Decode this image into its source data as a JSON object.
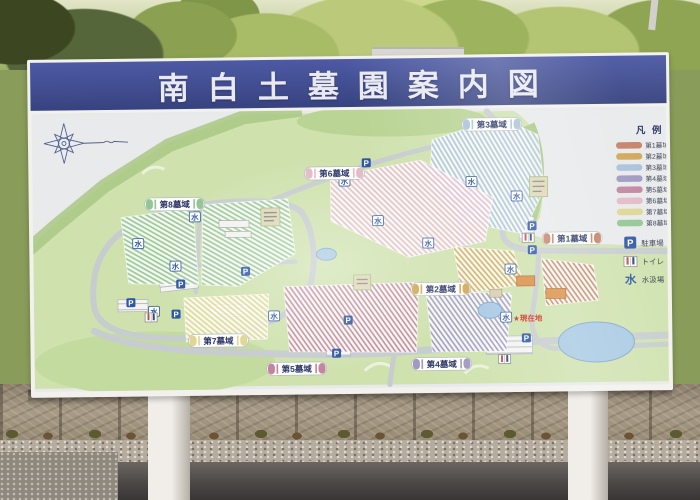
{
  "sign": {
    "title": "南白土墓園案内図"
  },
  "zones": [
    {
      "label": "第1墓域",
      "color": "#c5826a"
    },
    {
      "label": "第2墓域",
      "color": "#d2a757"
    },
    {
      "label": "第3墓域",
      "color": "#a9c2d9"
    },
    {
      "label": "第4墓域",
      "color": "#a099c1"
    },
    {
      "label": "第5墓域",
      "color": "#c2859f"
    },
    {
      "label": "第6墓域",
      "color": "#e3bac7"
    },
    {
      "label": "第7墓域",
      "color": "#ded692"
    },
    {
      "label": "第8墓域",
      "color": "#94c594"
    }
  ],
  "legend": {
    "title": "凡 例",
    "parking_label": "駐車場",
    "toilet_label": "トイレ",
    "water_label": "水汲場"
  },
  "map": {
    "current_location": "★現在地",
    "water_glyph": "水",
    "parking_glyph": "P"
  }
}
